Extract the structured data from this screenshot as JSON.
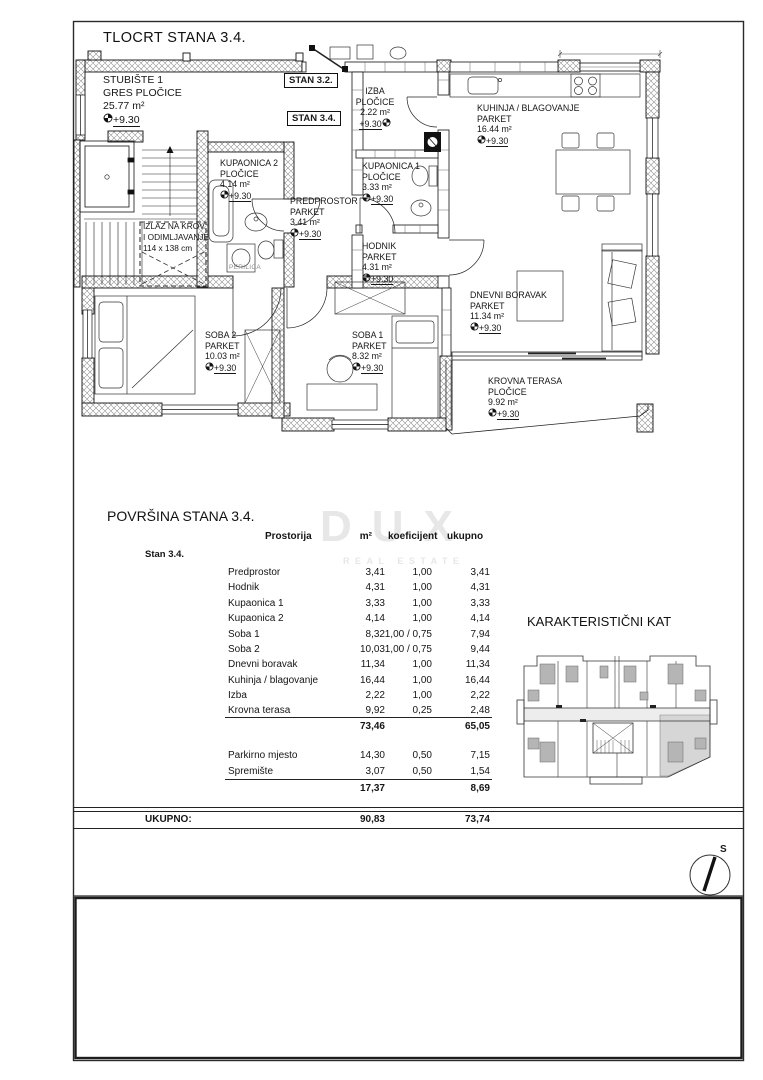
{
  "page": {
    "plan_title": "TLOCRT STANA 3.4.",
    "table_title": "POVRŠINA STANA 3.4.",
    "mini_plan_title": "KARAKTERISTIČNI KAT",
    "north_label": "S",
    "watermark_line1": "DUX",
    "watermark_line2": "REAL ESTATE"
  },
  "badges": {
    "stan_32": "STAN 3.2.",
    "stan_34": "STAN 3.4."
  },
  "plan": {
    "staircase": {
      "name": "STUBIŠTE 1",
      "material": "GRES PLOČICE",
      "area": "25.77 m²",
      "level": "+9.30"
    },
    "rooms": [
      {
        "id": "izba",
        "name": "IZBA",
        "material": "PLOČICE",
        "area": "2.22 m²",
        "level": "+9.30"
      },
      {
        "id": "kuhinja",
        "name": "KUHINJA / BLAGOVANJE",
        "material": "PARKET",
        "area": "16.44 m²",
        "level": "+9.30"
      },
      {
        "id": "kupaonica1",
        "name": "KUPAONICA 1",
        "material": "PLOČICE",
        "area": "3.33 m²",
        "level": "+9.30"
      },
      {
        "id": "kupaonica2",
        "name": "KUPAONICA 2",
        "material": "PLOČICE",
        "area": "4.14 m²",
        "level": "+9.30"
      },
      {
        "id": "predprostor",
        "name": "PREDPROSTOR",
        "material": "PARKET",
        "area": "3.41 m²",
        "level": "+9.30"
      },
      {
        "id": "hodnik",
        "name": "HODNIK",
        "material": "PARKET",
        "area": "4.31 m²",
        "level": "+9.30"
      },
      {
        "id": "soba2",
        "name": "SOBA 2",
        "material": "PARKET",
        "area": "10.03 m²",
        "level": "+9.30"
      },
      {
        "id": "soba1",
        "name": "SOBA 1",
        "material": "PARKET",
        "area": "8.32 m²",
        "level": "+9.30"
      },
      {
        "id": "dnevni",
        "name": "DNEVNI BORAVAK",
        "material": "PARKET",
        "area": "11.34 m²",
        "level": "+9.30"
      },
      {
        "id": "terasa",
        "name": "KROVNA TERASA",
        "material": "PLOČICE",
        "area": "9.92 m²",
        "level": "+9.30"
      }
    ],
    "roof_exit_line1": "IZLAZ NA KROV",
    "roof_exit_line2": "I ODIMLJAVANJE",
    "roof_exit_line3": "114 x 138 cm",
    "washer_label": "PERILICA"
  },
  "table": {
    "headers": {
      "room": "Prostorija",
      "m2": "m²",
      "koef": "koeficijent",
      "total": "ukupno"
    },
    "group_label": "Stan 3.4.",
    "rows": [
      {
        "label": "Predprostor",
        "m2": "3,41",
        "koef": "1,00",
        "total": "3,41"
      },
      {
        "label": "Hodnik",
        "m2": "4,31",
        "koef": "1,00",
        "total": "4,31"
      },
      {
        "label": "Kupaonica 1",
        "m2": "3,33",
        "koef": "1,00",
        "total": "3,33"
      },
      {
        "label": "Kupaonica 2",
        "m2": "4,14",
        "koef": "1,00",
        "total": "4,14"
      },
      {
        "label": "Soba 1",
        "m2": "8,32",
        "koef": "1,00 / 0,75",
        "total": "7,94"
      },
      {
        "label": "Soba 2",
        "m2": "10,03",
        "koef": "1,00 / 0,75",
        "total": "9,44"
      },
      {
        "label": "Dnevni boravak",
        "m2": "11,34",
        "koef": "1,00",
        "total": "11,34"
      },
      {
        "label": "Kuhinja / blagovanje",
        "m2": "16,44",
        "koef": "1,00",
        "total": "16,44"
      },
      {
        "label": "Izba",
        "m2": "2,22",
        "koef": "1,00",
        "total": "2,22"
      },
      {
        "label": "Krovna terasa",
        "m2": "9,92",
        "koef": "0,25",
        "total": "2,48"
      }
    ],
    "subtotal1": {
      "m2": "73,46",
      "total": "65,05"
    },
    "extra_rows": [
      {
        "label": "Parkirno mjesto",
        "m2": "14,30",
        "koef": "0,50",
        "total": "7,15"
      },
      {
        "label": "Spremište",
        "m2": "3,07",
        "koef": "0,50",
        "total": "1,54"
      }
    ],
    "subtotal2": {
      "m2": "17,37",
      "total": "8,69"
    },
    "total_row": {
      "label": "UKUPNO:",
      "m2": "90,83",
      "total": "73,74"
    }
  }
}
